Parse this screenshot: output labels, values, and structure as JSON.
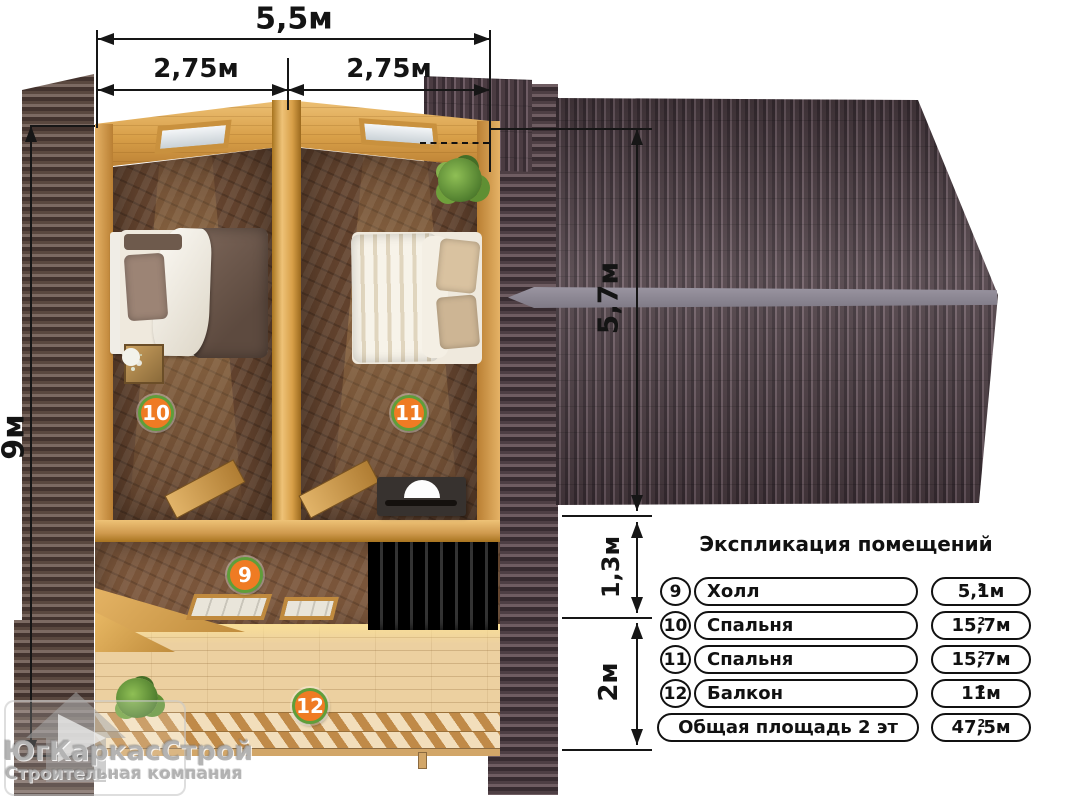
{
  "dimensions": {
    "total_width": "5,5м",
    "left_half": "2,75м",
    "right_half": "2,75м",
    "total_depth": "9м",
    "roof_depth": "5,7м",
    "hall_depth": "1,3м",
    "balcony_depth": "2м"
  },
  "plan_badges": {
    "hall": "9",
    "bedroom_left": "10",
    "bedroom_right": "11",
    "balcony": "12"
  },
  "legend": {
    "title": "Экспликация помещений",
    "rows": [
      {
        "num": "9",
        "name": "Холл",
        "area": "5,1м",
        "area_sup": "2"
      },
      {
        "num": "10",
        "name": "Спальня",
        "area": "15,7м",
        "area_sup": "2"
      },
      {
        "num": "11",
        "name": "Спальня",
        "area": "15,7м",
        "area_sup": "2"
      },
      {
        "num": "12",
        "name": "Балкон",
        "area": "11м",
        "area_sup": "2"
      }
    ],
    "total": {
      "label": "Общая площадь 2 эт",
      "area": "47,5м",
      "area_sup": "2"
    }
  },
  "watermark": {
    "company": "ЮгКаркасСтрой",
    "tagline": "Строительная компания"
  },
  "colors": {
    "badge_fill": "#ef7b23",
    "badge_ring": "#5f9e3a",
    "roof_dark": "#43343a",
    "roof_light": "#75636b",
    "ridge_gray": "#8d8893",
    "wall_wood": "#d49a47",
    "balcony_wood": "#ecd0a0",
    "dimension_ink": "#161616"
  }
}
